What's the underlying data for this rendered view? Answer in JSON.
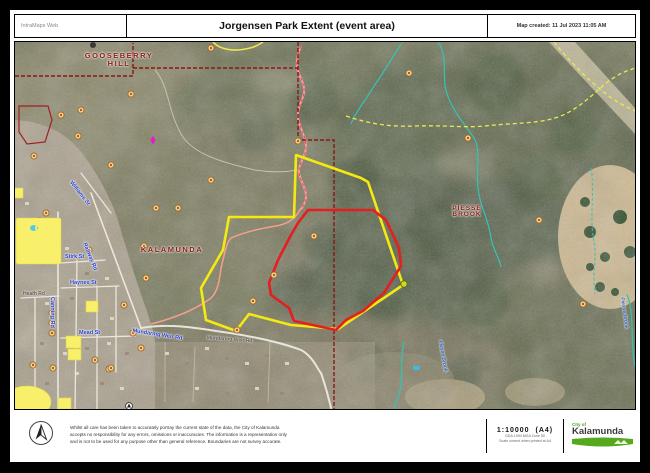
{
  "header": {
    "app_label": "IntraMaps Web",
    "title": "Jorgensen Park Extent (event area)",
    "created": "Map created: 11 Jul 2023 11:05 AM"
  },
  "map": {
    "suburb_labels": {
      "gooseberry_line1": "GOOSEBERRY",
      "gooseberry_line2": "HILL",
      "kalamunda": "KALAMUNDA",
      "piesse_line1": "PIESSE",
      "piesse_line2": "BROOK"
    },
    "road_labels": {
      "railway_rd": "Railway Rd",
      "stirk_st": "Stirk St",
      "haynes_st": "Haynes St",
      "mead_st": "Mead St",
      "heath_rd": "Heath Rd",
      "canning_rd": "Canning Rd",
      "williams_st": "Williams St",
      "mundaring_weir_rd": "Mundaring Weir Rd",
      "mundaring_weir_rd_2": "Mundaring Weir Rd"
    },
    "water_labels": {
      "piesse_brook_creek": "Piesse Brook",
      "piesse_brook_creek_2": "Piesse Brook"
    },
    "overlays": {
      "park_extent_outline_color": "#f4ea12",
      "event_area_outline_color": "#e51f1f",
      "suburb_boundary_color": "#8c1616",
      "creek_color": "#35c2b6",
      "trail_color": "#ece94f",
      "highlight_parcel_color": "#f8f06a",
      "road_label_color": "#2038c8",
      "suburb_label_color": "#8b1a1a"
    },
    "icons": {
      "poi_marker": "poi-circle-marker",
      "selected_point": "selection-marker",
      "north_arrow": "compass-north-arrow"
    }
  },
  "footer": {
    "disclaimer_line1": "Whilst all care has been taken to accurately portray the current state of the data, the City of Kalamunda",
    "disclaimer_line2": "accepts no responsibility for any errors, omissions or inaccuracies. The information is a representation only",
    "disclaimer_line3": "and is not to be used for any purpose other than general reference. Boundaries are not survey accurate.",
    "scale": "1:10000",
    "page_size": "(A4)",
    "scale_note_1": "GDA 1994 MGA Zone 50",
    "scale_note_2": "Scale correct when printed at A4",
    "logo": {
      "city_of": "City of",
      "name": "Kalamunda"
    }
  }
}
